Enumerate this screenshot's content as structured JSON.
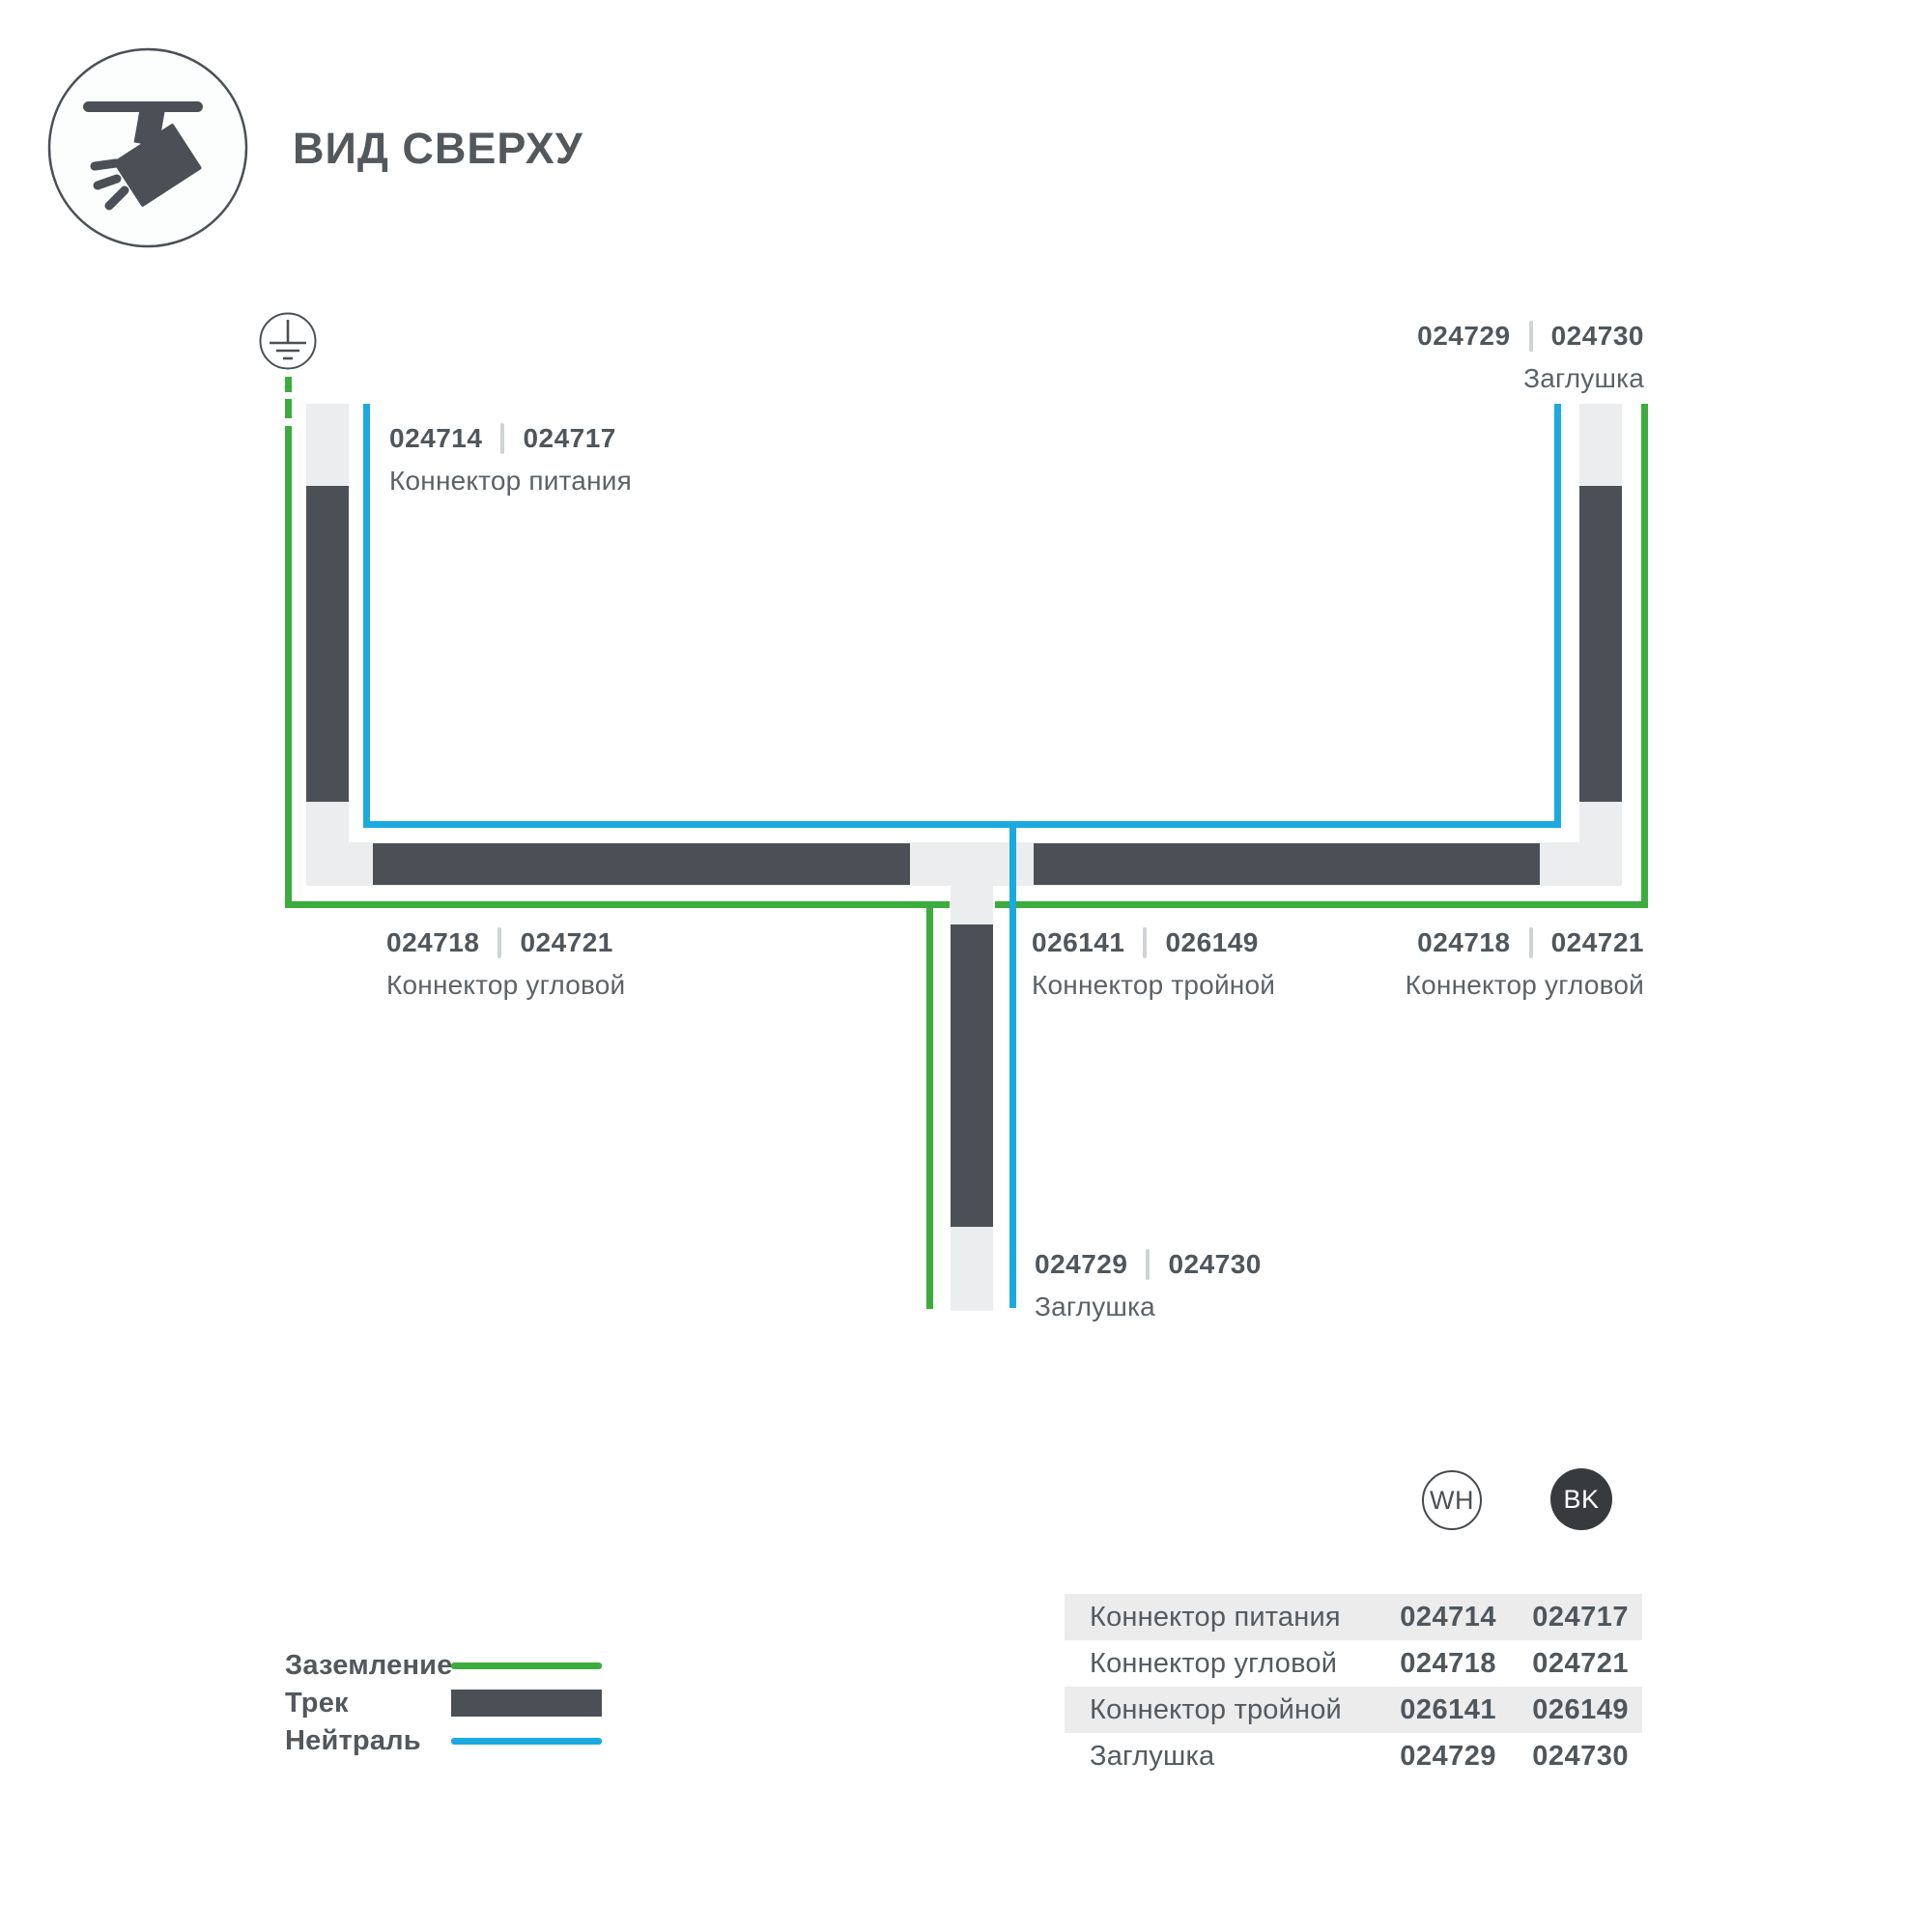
{
  "header": {
    "title": "ВИД СВЕРХУ"
  },
  "icon": {
    "name": "ceiling-track-spotlight"
  },
  "diagram": {
    "ground_symbol": "earth-ground",
    "labels": [
      {
        "key": "power-connector",
        "num_wh": "024714",
        "num_bk": "024717",
        "name": "Коннектор питания"
      },
      {
        "key": "endcap-top-right",
        "num_wh": "024729",
        "num_bk": "024730",
        "name": "Заглушка"
      },
      {
        "key": "corner-connector-left",
        "num_wh": "024718",
        "num_bk": "024721",
        "name": "Коннектор угловой"
      },
      {
        "key": "triple-connector",
        "num_wh": "026141",
        "num_bk": "026149",
        "name": "Коннектор тройной"
      },
      {
        "key": "corner-connector-right",
        "num_wh": "024718",
        "num_bk": "024721",
        "name": "Коннектор угловой"
      },
      {
        "key": "endcap-bottom",
        "num_wh": "024729",
        "num_bk": "024730",
        "name": "Заглушка"
      }
    ]
  },
  "legend": {
    "items": [
      {
        "label": "Заземление",
        "swatch": "ground-line"
      },
      {
        "label": "Трек",
        "swatch": "track-bar"
      },
      {
        "label": "Нейтраль",
        "swatch": "neutral-line"
      }
    ]
  },
  "swatches": {
    "wh_label": "WH",
    "bk_label": "BK"
  },
  "table": {
    "rows": [
      {
        "name": "Коннектор питания",
        "wh": "024714",
        "bk": "024717"
      },
      {
        "name": "Коннектор угловой",
        "wh": "024718",
        "bk": "024721"
      },
      {
        "name": "Коннектор тройной",
        "wh": "026141",
        "bk": "026149"
      },
      {
        "name": "Заглушка",
        "wh": "024729",
        "bk": "024730"
      }
    ]
  },
  "colors": {
    "ground_green": "#3bac3d",
    "neutral_blue": "#1ca9e0",
    "track_dark": "#4a5055",
    "track_light": "#ecedee",
    "row_stripe": "#ececec",
    "bk_circle": "#383b3e",
    "text_primary": "#53585d"
  }
}
